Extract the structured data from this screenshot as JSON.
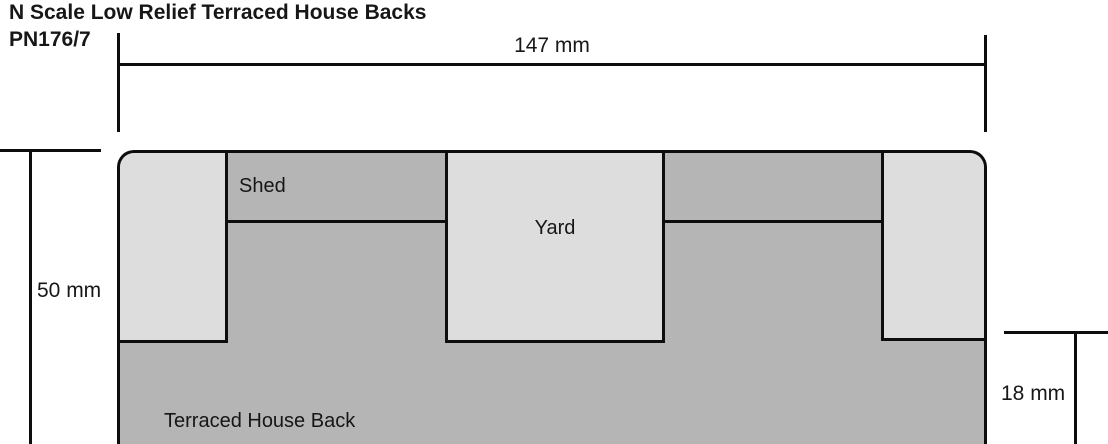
{
  "title": {
    "line1": "N Scale Low Relief Terraced House Backs",
    "line2": "PN176/7"
  },
  "dimensions": {
    "overall_width": "147 mm",
    "overall_height": "50 mm",
    "relief_depth": "18 mm"
  },
  "regions": {
    "shed": "Shed",
    "yard": "Yard",
    "house_back": "Terraced House Back"
  },
  "colors": {
    "panel_light_gray": "#dcdddc",
    "panel_dark_gray": "#b4b5b4",
    "line_black": "#0d0d0d",
    "background": "#ffffff"
  }
}
